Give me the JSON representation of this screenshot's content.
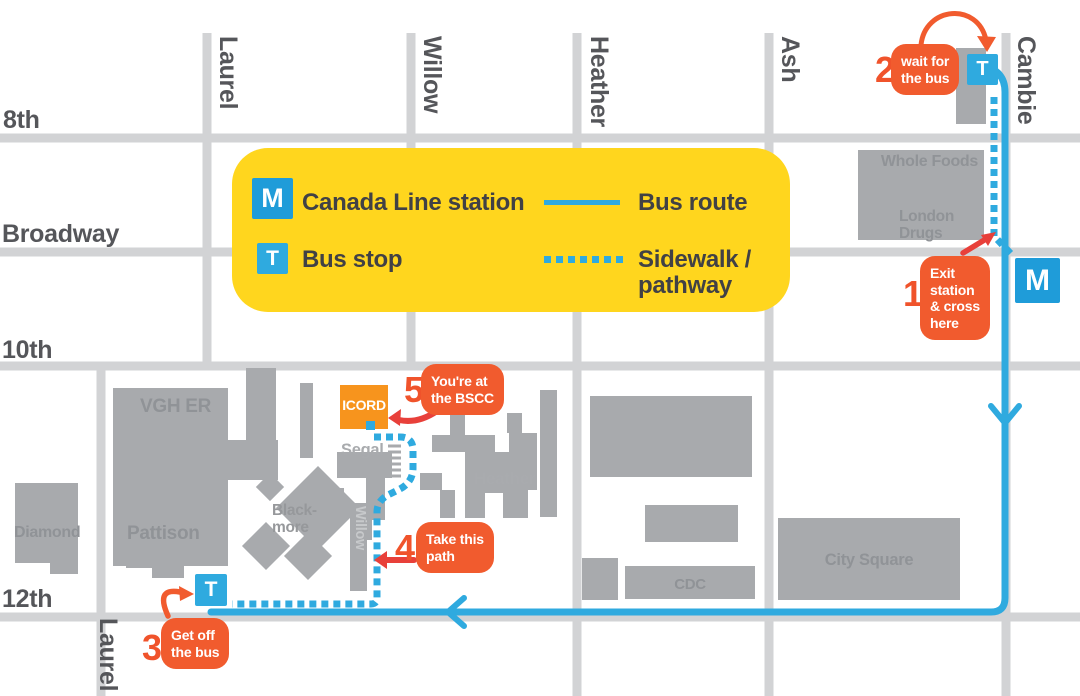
{
  "colors": {
    "bus_route_cyan": "#2FAADF",
    "canada_line_blue": "#1F9CD9",
    "callout_orange": "#F15B2E",
    "arrow_red": "#E8403A",
    "icord_orange": "#F7941D",
    "legend_yellow": "#FFD61E",
    "road_gray": "#D2D3D5",
    "building_gray": "#A8AAAD",
    "street_label_gray": "#55565A"
  },
  "legend": {
    "m_icon": "M",
    "canada_line_label": "Canada Line station",
    "t_icon": "T",
    "bus_stop_label": "Bus stop",
    "bus_route_label": "Bus route",
    "sidewalk_label_line1": "Sidewalk /",
    "sidewalk_label_line2": "pathway"
  },
  "streets": {
    "horizontal": {
      "eighth": "8th",
      "broadway": "Broadway",
      "tenth": "10th",
      "twelfth": "12th"
    },
    "vertical": {
      "laurel_top": "Laurel",
      "willow": "Willow",
      "heather": "Heather",
      "ash": "Ash",
      "cambie": "Cambie",
      "laurel_bottom": "Laurel"
    }
  },
  "buildings": {
    "whole_foods": "Whole Foods",
    "london_drugs": [
      "London",
      "Drugs"
    ],
    "vgh_er": "VGH ER",
    "pattison": "Pattison",
    "diamond": "Diamond",
    "blackmore": [
      "Black-",
      "more"
    ],
    "willow": "Willow",
    "segal": "Segal",
    "heather": "Heather",
    "cdc": "CDC",
    "city_square": "City Square",
    "icord": "ICORD"
  },
  "map_icons": {
    "bus_stop_top": "T",
    "station_m": "M",
    "bus_stop_bottom": "T"
  },
  "steps": {
    "1": {
      "number": "1",
      "lines": [
        "Exit",
        "station",
        "& cross",
        "here"
      ]
    },
    "2": {
      "number": "2",
      "lines": [
        "wait for",
        "the bus"
      ]
    },
    "3": {
      "number": "3",
      "lines": [
        "Get off",
        "the bus"
      ]
    },
    "4": {
      "number": "4",
      "lines": [
        "Take this",
        "path"
      ]
    },
    "5": {
      "number": "5",
      "lines": [
        "You're at",
        "the BSCC"
      ]
    }
  }
}
